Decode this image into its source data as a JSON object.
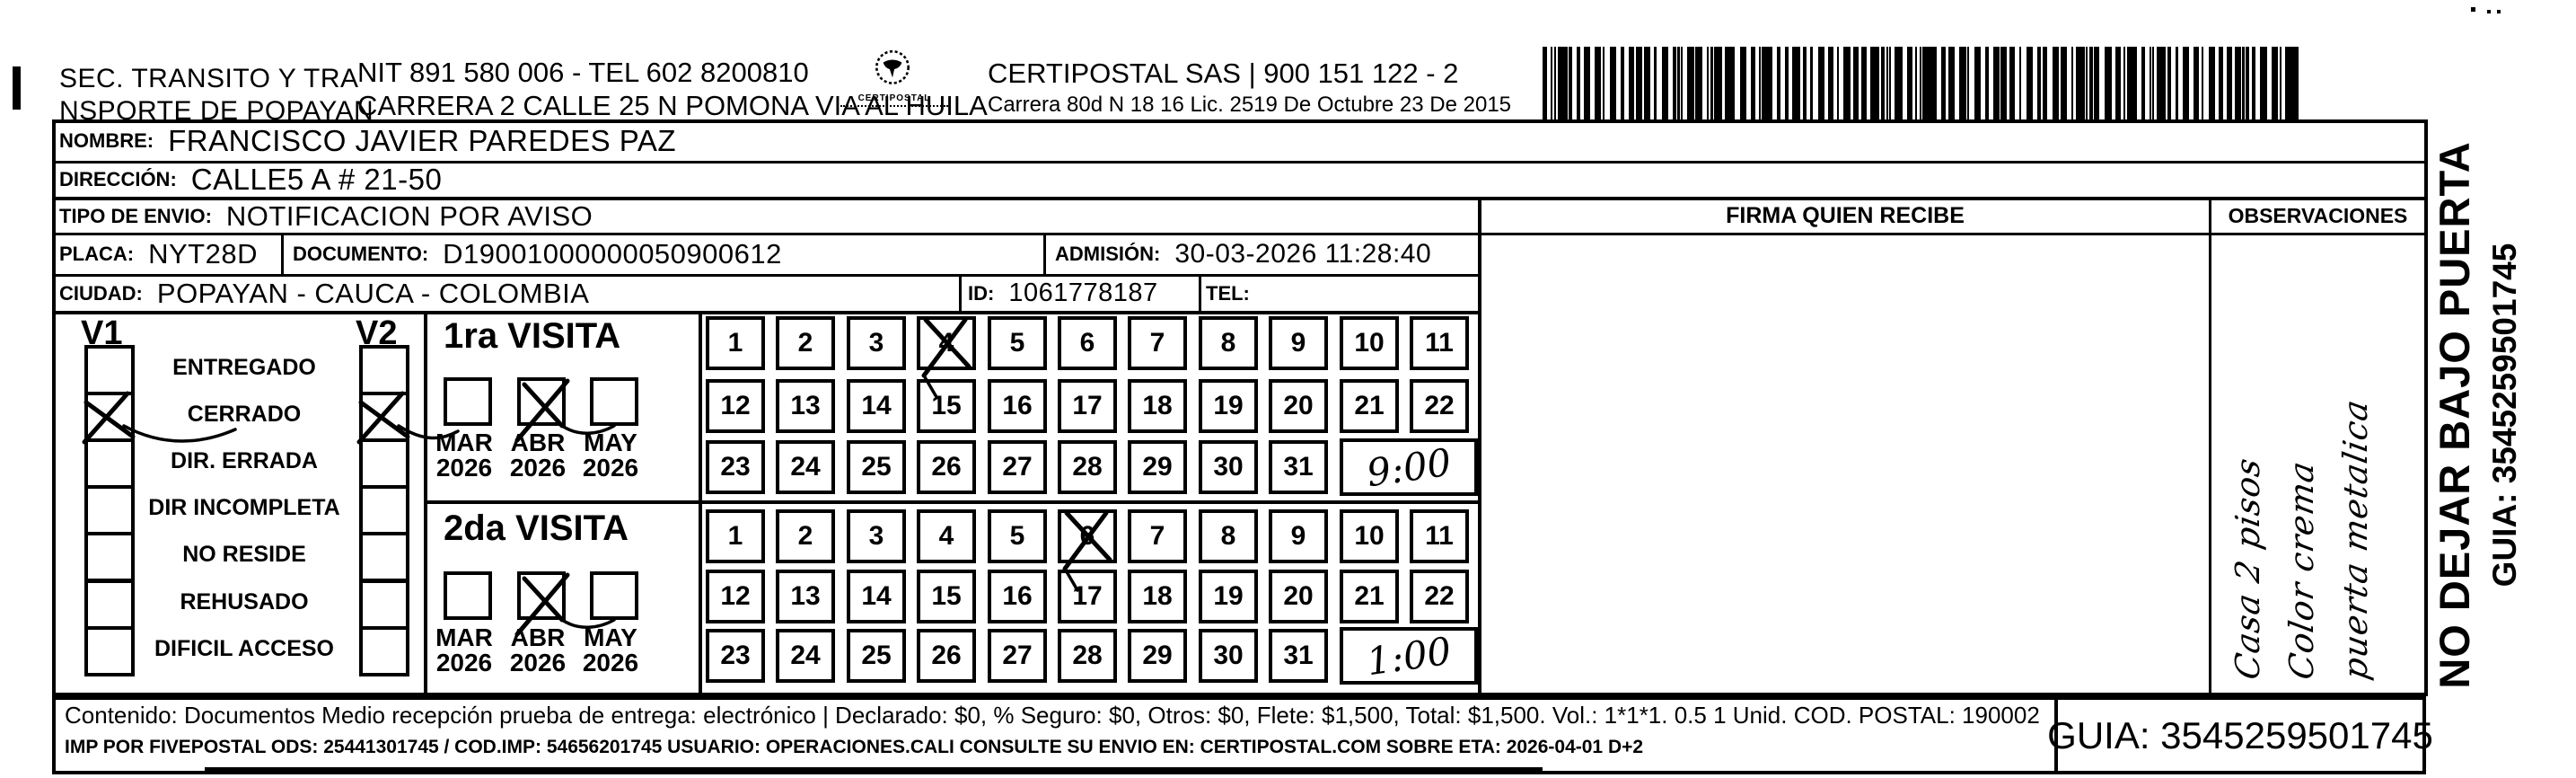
{
  "header": {
    "sender_line1": "SEC. TRANSITO Y TRA",
    "sender_line2": "NSPORTE DE POPAYAN",
    "sender_nit": "NIT 891 580 006 - TEL 602 8200810",
    "sender_address": "CARRERA 2 CALLE 25 N POMONA VIA AL HUILA",
    "logo_text": "CERTIPOSTAL",
    "courier_line": "CERTIPOSTAL SAS | 900 151 122 - 2",
    "courier_address": "Carrera 80d N 18 16  Lic. 2519 De Octubre 23 De 2015"
  },
  "shipment": {
    "nombre_label": "NOMBRE:",
    "nombre": "FRANCISCO JAVIER PAREDES PAZ",
    "direccion_label": "DIRECCIÓN:",
    "direccion": "CALLE5 A # 21-50",
    "tipo_envio_label": "TIPO DE ENVIO:",
    "tipo_envio": "NOTIFICACION POR AVISO",
    "placa_label": "PLACA:",
    "placa": "NYT28D",
    "documento_label": "DOCUMENTO:",
    "documento": "D19001000000050900612",
    "admision_label": "ADMISIÓN:",
    "admision": "30-03-2026 11:28:40",
    "ciudad_label": "CIUDAD:",
    "ciudad": "POPAYAN - CAUCA - COLOMBIA",
    "id_label": "ID:",
    "id_value": "1061778187",
    "tel_label": "TEL:",
    "tel": ""
  },
  "table_headers": {
    "firma": "FIRMA QUIEN RECIBE",
    "observaciones": "OBSERVACIONES"
  },
  "delivery_status": {
    "col1": "V1",
    "col2": "V2",
    "options": [
      {
        "label": "ENTREGADO",
        "v1_checked": false,
        "v2_checked": false
      },
      {
        "label": "CERRADO",
        "v1_checked": true,
        "v2_checked": true
      },
      {
        "label": "DIR. ERRADA",
        "v1_checked": false,
        "v2_checked": false
      },
      {
        "label": "DIR INCOMPLETA",
        "v1_checked": false,
        "v2_checked": false
      },
      {
        "label": "NO RESIDE",
        "v1_checked": false,
        "v2_checked": false
      },
      {
        "label": "REHUSADO",
        "v1_checked": false,
        "v2_checked": false
      },
      {
        "label": "DIFICIL ACCESO",
        "v1_checked": false,
        "v2_checked": false
      }
    ]
  },
  "visits": [
    {
      "title": "1ra VISITA",
      "months": [
        {
          "label": "MAR",
          "year": "2026",
          "checked": false
        },
        {
          "label": "ABR",
          "year": "2026",
          "checked": true
        },
        {
          "label": "MAY",
          "year": "2026",
          "checked": false
        }
      ],
      "marked_day": 4,
      "handwritten_time": "9:00"
    },
    {
      "title": "2da VISITA",
      "months": [
        {
          "label": "MAR",
          "year": "2026",
          "checked": false
        },
        {
          "label": "ABR",
          "year": "2026",
          "checked": true
        },
        {
          "label": "MAY",
          "year": "2026",
          "checked": false
        }
      ],
      "marked_day": 6,
      "handwritten_time": "1:00"
    }
  ],
  "calendar_days": [
    1,
    2,
    3,
    4,
    5,
    6,
    7,
    8,
    9,
    10,
    11,
    12,
    13,
    14,
    15,
    16,
    17,
    18,
    19,
    20,
    21,
    22,
    23,
    24,
    25,
    26,
    27,
    28,
    29,
    30,
    31
  ],
  "observaciones_handwriting": [
    "Casa 2 pisos",
    "Color crema",
    "puerta metalica"
  ],
  "side_notice": {
    "line1": "NO DEJAR BAJO PUERTA",
    "line2": "GUIA: 3545259501745"
  },
  "footer": {
    "content_line": "Contenido: Documentos Medio recepción prueba de entrega: electrónico | Declarado: $0, % Seguro: $0, Otros: $0, Flete: $1,500, Total: $1,500. Vol.: 1*1*1. 0.5  1 Unid. COD. POSTAL: 190002",
    "ops_line": "IMP POR FIVEPOSTAL ODS: 25441301745 / COD.IMP: 54656201745 USUARIO: OPERACIONES.CALI CONSULTE SU ENVIO EN: CERTIPOSTAL.COM SOBRE ETA: 2026-04-01 D+2",
    "guia": "GUIA: 3545259501745"
  },
  "accents": {
    "ink": "#000000",
    "paper": "#ffffff"
  }
}
